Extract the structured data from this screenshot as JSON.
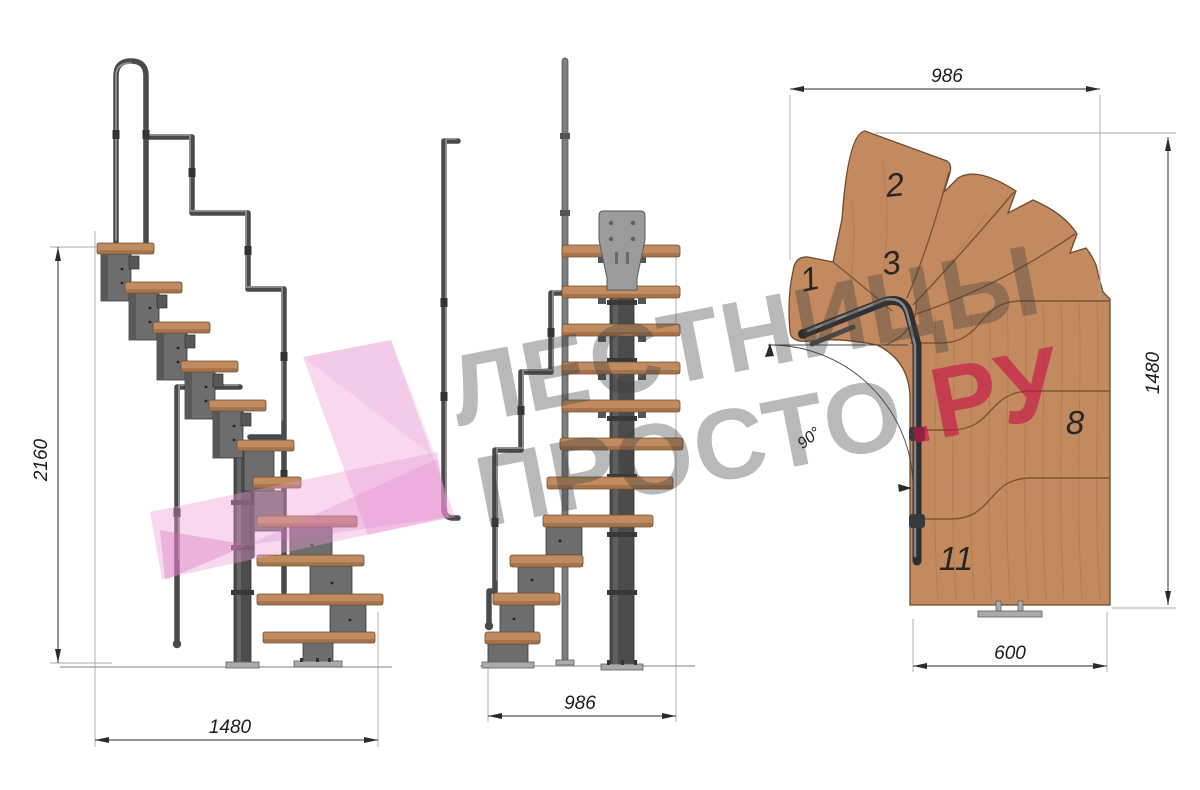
{
  "drawing": {
    "side_view": {
      "height_mm": "2160",
      "width_mm": "1480"
    },
    "front_view": {
      "width_mm": "986"
    },
    "plan_view": {
      "width_mm": "986",
      "depth_mm": "1480",
      "tread_width_mm": "600",
      "turn_angle": "90°",
      "tread_numbers": {
        "n1": "1",
        "n2": "2",
        "n3": "3",
        "n8": "8",
        "n11": "11"
      }
    }
  },
  "watermark": {
    "line1": "ЛЕСТНИЦЫ",
    "line2_gray": "ПРОСТО",
    "line2_pink": ".РУ"
  },
  "colors": {
    "wood": "#c28a5e",
    "wood_edge": "#6e4b2d",
    "metal": "#6d6d6d",
    "metal_dark": "#4c4c4c",
    "dimension": "#2b2b2b",
    "watermark_pink": "#eaa8d9",
    "watermark_accent": "#c61049",
    "watermark_gray": "#aaaaaa"
  }
}
